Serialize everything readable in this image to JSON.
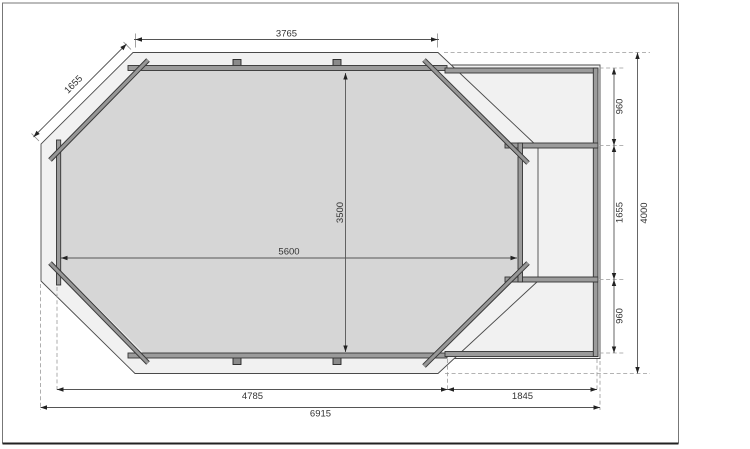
{
  "drawing": {
    "description": "octagonal-pool-floor-plan-with-side-annex",
    "dimensions": {
      "top_width": "3765",
      "diagonal_side": "1655",
      "pool_inner_length": "5600",
      "pool_inner_width": "3500",
      "annex_top": "960",
      "annex_middle": "1655",
      "annex_bottom": "960",
      "overall_height": "4000",
      "bottom_main": "4785",
      "bottom_annex": "1845",
      "overall_width": "6915"
    },
    "colors": {
      "deck_fill": "#f1f1f1",
      "pool_fill": "#d6d6d6",
      "wall_fill": "#9b9b9b",
      "line_color": "#444444"
    }
  }
}
